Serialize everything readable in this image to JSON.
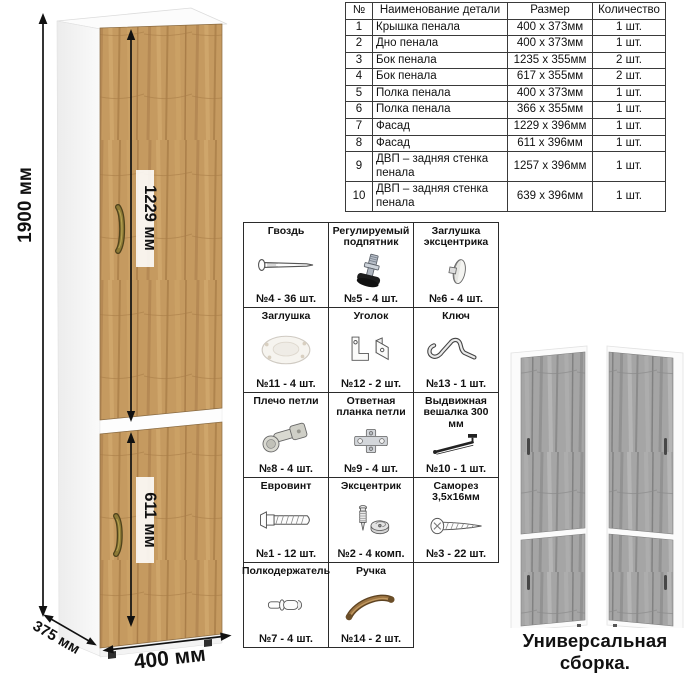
{
  "cabinet": {
    "dim_height": "1900 мм",
    "dim_upper_door": "1229 мм",
    "dim_lower_door": "611 мм",
    "dim_width": "400 мм",
    "dim_depth": "375 мм"
  },
  "parts_table": {
    "headers": [
      "№",
      "Наименование детали",
      "Размер",
      "Количество"
    ],
    "rows": [
      [
        "1",
        "Крышка пенала",
        "400 х 373мм",
        "1 шт."
      ],
      [
        "2",
        "Дно пенала",
        "400 х 373мм",
        "1 шт."
      ],
      [
        "3",
        "Бок пенала",
        "1235 х 355мм",
        "2 шт."
      ],
      [
        "4",
        "Бок пенала",
        "617 х 355мм",
        "2 шт."
      ],
      [
        "5",
        "Полка пенала",
        "400 х 373мм",
        "1 шт."
      ],
      [
        "6",
        "Полка пенала",
        "366 х 355мм",
        "1 шт."
      ],
      [
        "7",
        "Фасад",
        "1229 х 396мм",
        "1 шт."
      ],
      [
        "8",
        "Фасад",
        "611 х 396мм",
        "1 шт."
      ],
      [
        "9",
        "ДВП – задняя стенка пенала",
        "1257 х 396мм",
        "1 шт."
      ],
      [
        "10",
        "ДВП – задняя стенка пенала",
        "639 х 396мм",
        "1 шт."
      ]
    ]
  },
  "hardware": {
    "items": [
      {
        "name": "Гвоздь",
        "icon": "nail-icon",
        "count": "№4 - 36 шт."
      },
      {
        "name": "Регулируемый подпятник",
        "icon": "adjustable-foot-icon",
        "count": "№5 - 4 шт."
      },
      {
        "name": "Заглушка эксцентрика",
        "icon": "cam-cover-icon",
        "count": "№6 - 4 шт."
      },
      {
        "name": "Заглушка",
        "icon": "cap-icon",
        "count": "№11 - 4 шт."
      },
      {
        "name": "Уголок",
        "icon": "corner-bracket-icon",
        "count": "№12 - 2 шт."
      },
      {
        "name": "Ключ",
        "icon": "key-icon",
        "count": "№13 - 1 шт."
      },
      {
        "name": "Плечо петли",
        "icon": "hinge-arm-icon",
        "count": "№8 - 4 шт."
      },
      {
        "name": "Ответная планка петли",
        "icon": "hinge-plate-icon",
        "count": "№9 - 4 шт."
      },
      {
        "name": "Выдвижная вешалка 300 мм",
        "icon": "pullout-hanger-icon",
        "count": "№10 - 1 шт."
      },
      {
        "name": "Евровинт",
        "icon": "euro-screw-icon",
        "count": "№1 - 12 шт."
      },
      {
        "name": "Эксцентрик",
        "icon": "cam-lock-icon",
        "count": "№2 - 4 комп."
      },
      {
        "name": "Саморез 3,5х16мм",
        "icon": "self-tapping-screw-icon",
        "count": "№3 - 22 шт."
      },
      {
        "name": "Полкодержатель",
        "icon": "shelf-pin-icon",
        "count": "№7 - 4 шт."
      },
      {
        "name": "Ручка",
        "icon": "handle-icon",
        "count": "№14 - 2 шт."
      }
    ]
  },
  "footer": {
    "caption": "Универсальная сборка."
  },
  "colors": {
    "wood": "#c59a60",
    "wood_dark": "#a87c47",
    "wood_light": "#d4aa70",
    "gray_wood": "#a5a5a5",
    "handle_bronze": "#8d7a36",
    "line": "#111111"
  }
}
